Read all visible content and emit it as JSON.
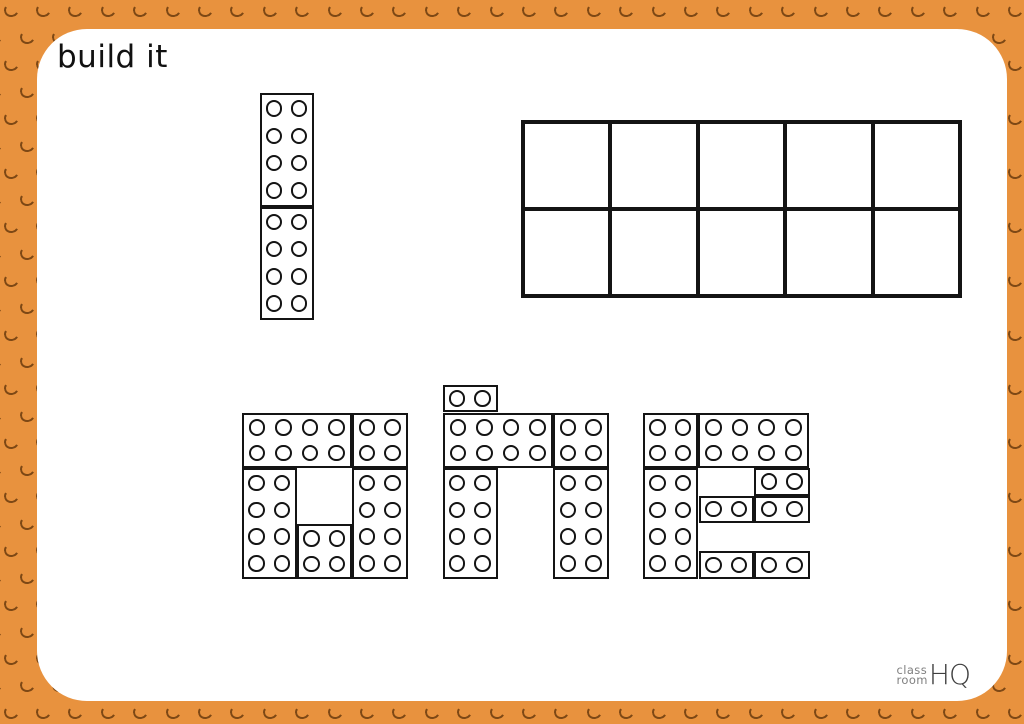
{
  "title": "build it",
  "colors": {
    "background_orange": "#E8923E",
    "stud_shadow": "#6F3E10",
    "card_white": "#FFFFFF",
    "line_black": "#141414",
    "logo_gray": "#7F7F7F",
    "logo_dark_gray": "#3F3F3F"
  },
  "logo": {
    "top": "class",
    "bottom": "room",
    "mark": "HQ"
  },
  "ten_frame": {
    "rows": 2,
    "cols": 5,
    "x": 484,
    "y": 90.5,
    "w": 441,
    "h": 178,
    "filled": 0
  },
  "numeral": {
    "value": "1",
    "bricks": [
      {
        "x": 222.5,
        "y": 64,
        "w": 54.5,
        "h": 113.5,
        "cols": 2,
        "rows": 4
      },
      {
        "x": 222.5,
        "y": 177.5,
        "w": 54.5,
        "h": 113,
        "cols": 2,
        "rows": 4
      }
    ]
  },
  "word": {
    "text": "one",
    "letters": [
      {
        "letter": "o",
        "bricks": [
          {
            "x": 204.5,
            "y": 383.5,
            "w": 110.5,
            "h": 55.4,
            "cols": 4,
            "rows": 2
          },
          {
            "x": 315,
            "y": 383.5,
            "w": 55.5,
            "h": 55.4,
            "cols": 2,
            "rows": 2
          },
          {
            "x": 204.5,
            "y": 438.9,
            "w": 55.5,
            "h": 111.1,
            "cols": 2,
            "rows": 4
          },
          {
            "x": 260,
            "y": 494.6,
            "w": 55,
            "h": 55.4,
            "cols": 2,
            "rows": 2
          },
          {
            "x": 315,
            "y": 438.9,
            "w": 55.5,
            "h": 111.1,
            "cols": 2,
            "rows": 4
          }
        ]
      },
      {
        "letter": "n",
        "bricks": [
          {
            "x": 405.5,
            "y": 355.8,
            "w": 55,
            "h": 27.7,
            "cols": 2,
            "rows": 1
          },
          {
            "x": 405.5,
            "y": 383.5,
            "w": 110.5,
            "h": 55.4,
            "cols": 4,
            "rows": 2
          },
          {
            "x": 516,
            "y": 383.5,
            "w": 55.5,
            "h": 55.4,
            "cols": 2,
            "rows": 2
          },
          {
            "x": 405.5,
            "y": 438.9,
            "w": 55,
            "h": 111.1,
            "cols": 2,
            "rows": 4
          },
          {
            "x": 516,
            "y": 438.9,
            "w": 55.5,
            "h": 111.1,
            "cols": 2,
            "rows": 4
          }
        ]
      },
      {
        "letter": "e",
        "bricks": [
          {
            "x": 606,
            "y": 383.5,
            "w": 55,
            "h": 55.4,
            "cols": 2,
            "rows": 2
          },
          {
            "x": 661,
            "y": 383.5,
            "w": 111,
            "h": 55.4,
            "cols": 4,
            "rows": 2
          },
          {
            "x": 606,
            "y": 438.9,
            "w": 55,
            "h": 111.1,
            "cols": 2,
            "rows": 4
          },
          {
            "x": 717,
            "y": 438.9,
            "w": 55.5,
            "h": 27.7,
            "cols": 2,
            "rows": 1
          },
          {
            "x": 661.5,
            "y": 466.6,
            "w": 55.5,
            "h": 27.7,
            "cols": 2,
            "rows": 1
          },
          {
            "x": 717,
            "y": 466.6,
            "w": 55.5,
            "h": 27.7,
            "cols": 2,
            "rows": 1
          },
          {
            "x": 661.5,
            "y": 522.3,
            "w": 55.5,
            "h": 27.7,
            "cols": 2,
            "rows": 1
          },
          {
            "x": 717,
            "y": 522.3,
            "w": 55.5,
            "h": 27.7,
            "cols": 2,
            "rows": 1
          }
        ]
      }
    ]
  },
  "border_pattern": {
    "x_step": 32.4,
    "y_step": 27,
    "x0_even": 11,
    "x0_odd": 27,
    "y0": 10,
    "stud_w": 15,
    "stud_h": 14
  }
}
